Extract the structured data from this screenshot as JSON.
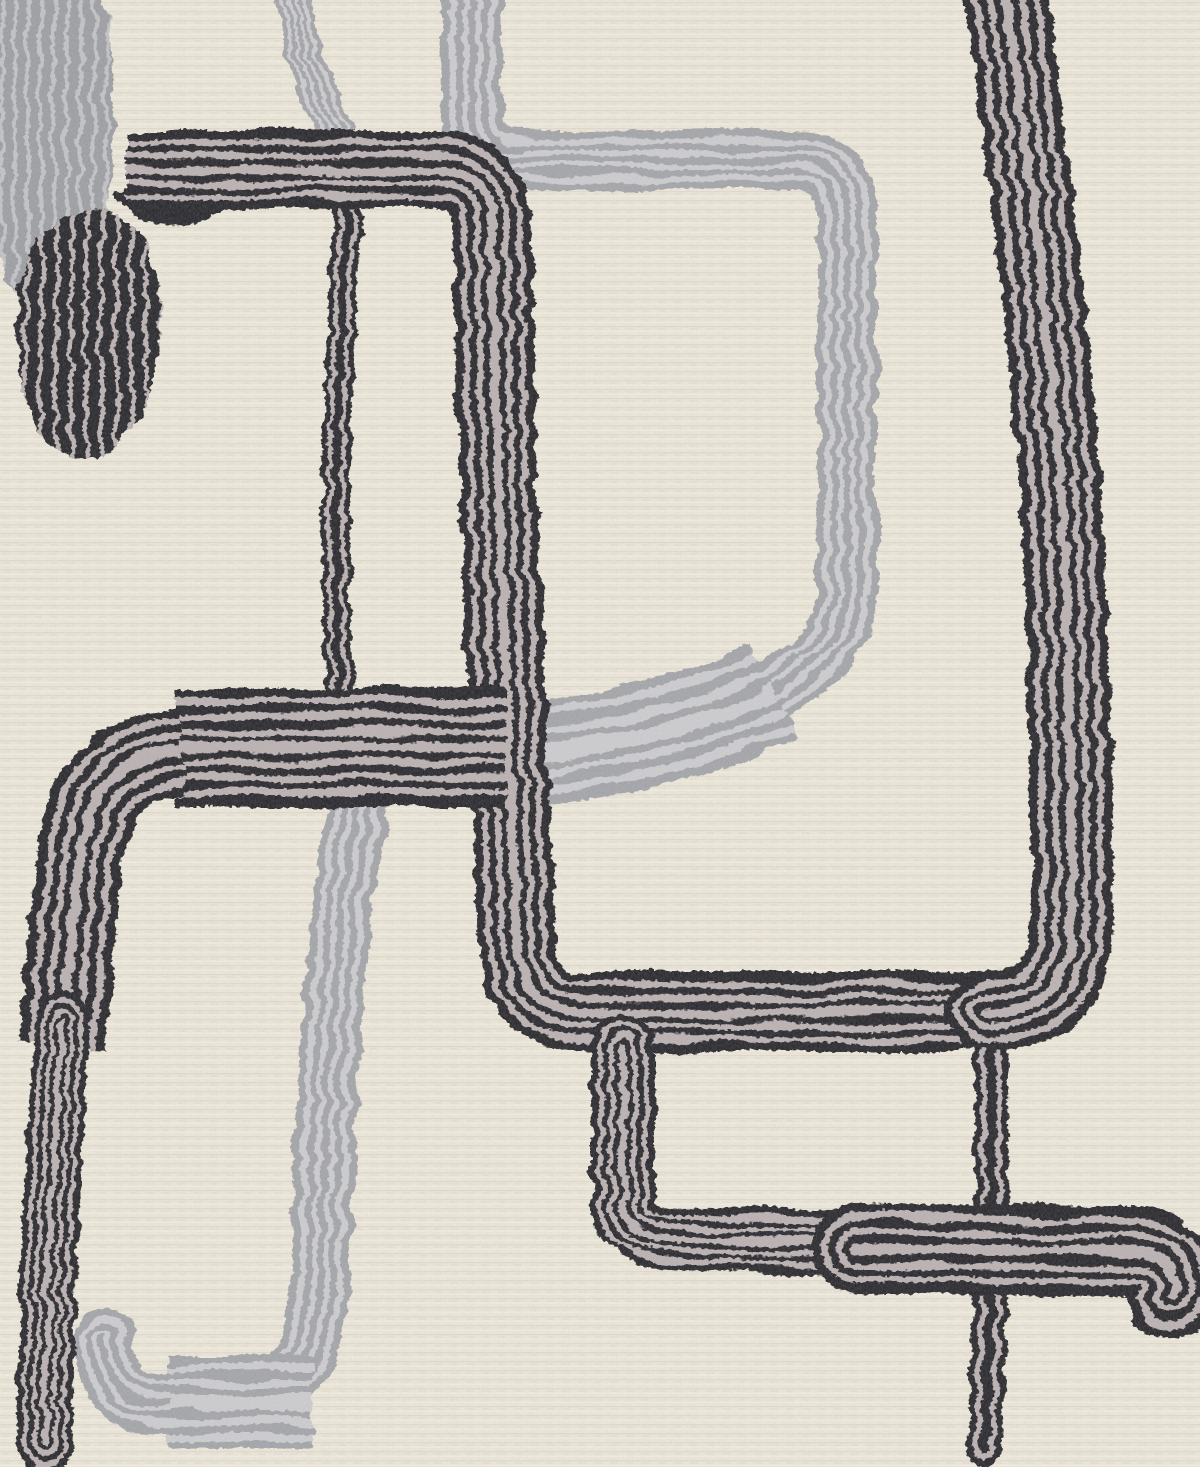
{
  "meta": {
    "title": "Abstract rug close-up",
    "description": "Close-up detail of a cream textured area rug with an abstract mid-century pattern of looping black and gray striped yarn ribbons, a striped black oval blob and a gray finger-shaped blob in the upper left."
  },
  "canvas": {
    "width": 1200,
    "height": 1467
  },
  "palette": {
    "bg_base": "#e9e4d6",
    "bg_row_dark": "#dcd5c5",
    "bg_row_light": "#f2ede0",
    "bg_dash": "#e0dacb",
    "black_ink": "#17161b",
    "black_stripe": "#b4aaac",
    "gray_ink": "#9b9da3",
    "gray_stripe": "#c7c7cc",
    "grayblob_ink": "#94969c",
    "grayblob_stripe": "#bcbdc2"
  },
  "ring_schemes": {
    "wide7": [
      [
        1,
        "i"
      ],
      [
        0.84,
        "s"
      ],
      [
        0.72,
        "i"
      ],
      [
        0.58,
        "s"
      ],
      [
        0.46,
        "i"
      ],
      [
        0.32,
        "s"
      ],
      [
        0.2,
        "i"
      ],
      [
        0.09,
        "s"
      ]
    ],
    "wide5": [
      [
        1,
        "i"
      ],
      [
        0.78,
        "s"
      ],
      [
        0.62,
        "i"
      ],
      [
        0.44,
        "s"
      ],
      [
        0.28,
        "i"
      ],
      [
        0.12,
        "s"
      ]
    ],
    "thin": [
      [
        1,
        "i"
      ],
      [
        0.62,
        "s"
      ],
      [
        0.3,
        "i"
      ]
    ],
    "gray3": [
      [
        1,
        "i"
      ],
      [
        0.74,
        "s"
      ],
      [
        0.52,
        "i"
      ],
      [
        0.3,
        "s"
      ],
      [
        0.12,
        "i"
      ]
    ],
    "gray5": [
      [
        1,
        "i"
      ],
      [
        0.82,
        "s"
      ],
      [
        0.66,
        "i"
      ],
      [
        0.48,
        "s"
      ],
      [
        0.32,
        "i"
      ],
      [
        0.16,
        "s"
      ]
    ]
  },
  "layers": [
    {
      "name": "gray-yarn-layer",
      "filter": "roughGray",
      "items": [
        {
          "kind": "blob",
          "name": "gray-finger-blob",
          "ink": "grayblob",
          "d": "M -8 -8 L 102 -8 C 116 60, 116 140, 107 205 C 100 262, 80 312, 50 320 C 22 326, 2 278, -8 218 Z",
          "stripes": {
            "x0": 4,
            "step": 13,
            "count": 9,
            "y0": -8,
            "y1": 330,
            "bow": 5,
            "width": 4
          }
        },
        {
          "kind": "ribbon",
          "name": "gray-top-short-line",
          "ink": "gray",
          "d": "M 292 -8 C 300 48, 318 102, 336 140",
          "width": 36,
          "scheme": "gray3",
          "caps": "round"
        },
        {
          "kind": "ribbon",
          "name": "gray-big-loop",
          "ink": "gray",
          "d": "M 472 -12 L 472 114 Q 472 160 518 160 L 794 160 Q 847 160 847 210 L 847 588 Q 847 650 780 686 C 718 716, 622 740, 540 750 C 470 757, 392 746, 362 800 C 342 872, 324 1060, 322 1250 Q 322 1398 236 1403 L 164 1403 Q 104 1403 104 1338",
          "width": 60,
          "scheme": "gray3",
          "caps": "round"
        },
        {
          "kind": "ribbon",
          "name": "gray-loop-bottom-band",
          "ink": "gray",
          "d": "M 775 692 C 715 722, 625 742, 545 752 C 505 756, 475 757, 452 757",
          "width": 104,
          "scheme": "gray5",
          "caps": "butt"
        },
        {
          "kind": "ribbon",
          "name": "gray-lower-left-band",
          "ink": "gray",
          "d": "M 312 1403 L 168 1403",
          "width": 94,
          "scheme": "gray5",
          "caps": "butt"
        }
      ]
    },
    {
      "name": "black-yarn-layer",
      "filter": "roughBlack",
      "items": [
        {
          "kind": "blob",
          "name": "black-band-droop",
          "ink": "black",
          "d": "M 116 198 C 126 220, 160 230, 202 221 C 226 215, 234 206, 232 198 L 116 192 Z"
        },
        {
          "kind": "ribbon",
          "name": "black-thin-upper-line",
          "ink": "black",
          "d": "M 348 200 C 340 340, 330 520, 340 690",
          "width": 28,
          "scheme": "thin",
          "caps": "round"
        },
        {
          "kind": "ribbon",
          "name": "black-thin-lower-line",
          "ink": "black",
          "d": "M 990 1046 C 993 1150, 993 1300, 984 1448",
          "width": 34,
          "scheme": "thin",
          "caps": "round"
        },
        {
          "kind": "ribbon",
          "name": "black-top-left-structure",
          "ink": "black",
          "d": "M 126 170 L 440 170 Q 490 172 492 222 C 495 430, 507 720, 517 940 Q 521 1012 575 1012 L 1020 1012",
          "width": 78,
          "scheme": "wide5",
          "caps": "butt"
        },
        {
          "kind": "ribbon",
          "name": "black-right-diagonal",
          "ink": "black",
          "d": "M 1004 -16 C 1034 200, 1060 420, 1066 600 C 1072 780, 1074 900, 1070 944 Q 1063 1012 988 1012",
          "width": 82,
          "scheme": "wide5",
          "caps": "round"
        },
        {
          "kind": "ribbon",
          "name": "black-lower-right-loop",
          "ink": "black",
          "d": "M 623 1046 L 623 1196 Q 623 1238 672 1238 L 900 1246",
          "width": 64,
          "scheme": "wide5",
          "caps": "round"
        },
        {
          "kind": "ribbon",
          "name": "black-lower-right-band",
          "ink": "black",
          "d": "M 856 1248 L 1128 1252 Q 1182 1252 1172 1294",
          "width": 88,
          "scheme": "wide5",
          "caps": "round"
        },
        {
          "kind": "ribbon",
          "name": "black-mid-band",
          "ink": "black",
          "d": "M 506 747 L 176 747",
          "width": 118,
          "scheme": "wide7",
          "caps": "butt"
        },
        {
          "kind": "ribbon",
          "name": "black-mid-band-corner",
          "ink": "black",
          "d": "M 182 751 Q 94 758 81 848 C 74 910, 67 980, 62 1045",
          "width": 88,
          "scheme": "wide5",
          "caps": "butt"
        },
        {
          "kind": "ribbon",
          "name": "black-left-descender",
          "ink": "black",
          "d": "M 62 1020 C 52 1180, 46 1320, 44 1446",
          "width": 56,
          "scheme": "wide5",
          "caps": "round"
        },
        {
          "kind": "blob",
          "name": "black-egg-blob",
          "ink": "black",
          "d": "M 85 214 C 130 208, 158 240, 160 305 C 162 362, 148 418, 118 446 C 92 468, 52 460, 36 424 C 18 384, 10 315, 22 270 C 34 230, 58 218, 85 214 Z",
          "stripes": {
            "x0": 28,
            "step": 15,
            "count": 10,
            "y0": 204,
            "y1": 470,
            "bow": 5,
            "width": 4.5
          }
        }
      ]
    }
  ]
}
